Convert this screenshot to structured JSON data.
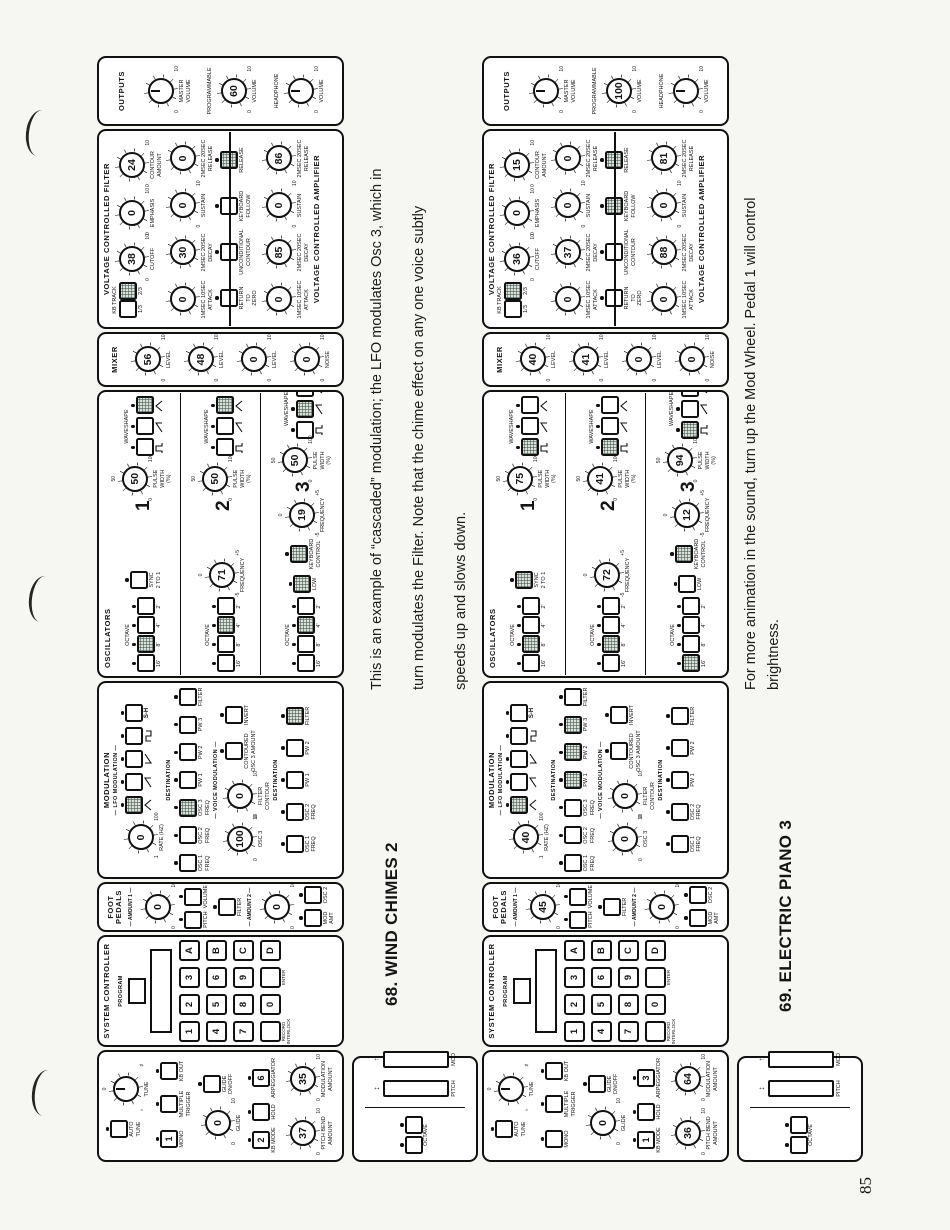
{
  "page": {
    "number": "85",
    "paper_color": "#f6f6f2",
    "ink_color": "#151515"
  },
  "labels": {
    "performance": {
      "auto_tune": "AUTO TUNE",
      "tune": "TUNE",
      "mono": "MONO",
      "multiple_trigger": "MULTIPLE TRIGGER",
      "kb_out": "KB OUT",
      "glide": "GLIDE",
      "glide_on_off": "GLIDE ON/OFF",
      "kb_mode": "KB MODE",
      "hold": "HOLD",
      "arpeggiator": "ARPEGGIATOR",
      "pitch_bend_amount": "PITCH BEND AMOUNT",
      "modulation_amount": "MODULATION AMOUNT"
    },
    "wheels": {
      "octave": "OCTAVE",
      "pitch": "PITCH",
      "mod": "MOD"
    },
    "system_controller": {
      "title": "SYSTEM CONTROLLER",
      "program": "PROGRAM",
      "keys": [
        [
          "1",
          "2",
          "3",
          "A"
        ],
        [
          "4",
          "5",
          "6",
          "B"
        ],
        [
          "7",
          "8",
          "9",
          "C"
        ],
        [
          "",
          "0",
          "",
          "D"
        ]
      ],
      "record_interlock": "RECORD INTERLOCK",
      "enter": "ENTER"
    },
    "foot_pedals": {
      "title": "FOOT PEDALS",
      "amount_1": "AMOUNT 1",
      "amount_2": "AMOUNT 2",
      "pitch": "PITCH",
      "volume": "VOLUME",
      "filter": "FILTER",
      "mod_amt": "MOD AMT",
      "osc_2": "OSC 2"
    },
    "modulation": {
      "title": "MODULATION",
      "lfo": "LFO MODULATION",
      "rate": "RATE (HZ)",
      "rate_scale": [
        ".1",
        "100"
      ],
      "destination": "DESTINATION",
      "waveforms": [
        "triangle",
        "saw-up",
        "saw-down",
        "square",
        "sample-hold"
      ],
      "sample_hold_text": "S-H",
      "lfo_destinations": [
        "OSC 1 FREQ",
        "OSC 2 FREQ",
        "OSC 3 FREQ",
        "PW 1",
        "PW 2",
        "PW 3",
        "FILTER"
      ],
      "voice": "VOICE MODULATION",
      "osc_3": "OSC 3",
      "filter_contour": "FILTER CONTOUR",
      "contoured": "CONTOURED OSC 3 AMOUNT",
      "invert": "INVERT",
      "voice_destinations": [
        "OSC 1 FREQ",
        "OSC 2 FREQ",
        "PW 1",
        "PW 2",
        "FILTER"
      ]
    },
    "oscillators": {
      "title": "OSCILLATORS",
      "octave": "OCTAVE",
      "octaves": [
        "16'",
        "8'",
        "4'",
        "2'"
      ],
      "sync": "SYNC 2 TO 1",
      "frequency": "FREQUENCY",
      "freq_scale": [
        "-5",
        "+5",
        "0"
      ],
      "low": "LOW",
      "keyboard_control": "KEYBOARD CONTROL",
      "pulse_width": "PULSE WIDTH (%)",
      "pw_scale": [
        "0",
        "100",
        "50"
      ],
      "waveshape": "WAVESHAPE",
      "waveshapes": [
        "pulse",
        "saw",
        "triangle"
      ],
      "numbers": [
        "1",
        "2",
        "3"
      ]
    },
    "mixer": {
      "title": "MIXER",
      "level": "LEVEL",
      "noise": "NOISE"
    },
    "vcf": {
      "title": "VOLTAGE CONTROLLED FILTER",
      "kb_track": "KB TRACK",
      "kb_track_options": [
        "1/3",
        "2/3"
      ],
      "cutoff": "CUTOFF",
      "emphasis": "EMPHASIS",
      "contour_amount": "CONTOUR AMOUNT",
      "attack": "ATTACK",
      "decay": "DECAY",
      "sustain": "SUSTAIN",
      "release": "RELEASE",
      "attack_scale": "1MSEC 10SEC",
      "decay_scale": "2MSEC 20SEC",
      "release_scale": "2MSEC 20SEC",
      "mode_buttons": [
        "RETURN TO ZERO",
        "UNCONDITIONAL CONTOUR",
        "KEYBOARD FOLLOW",
        "RELEASE"
      ]
    },
    "vca": {
      "title": "VOLTAGE CONTROLLED AMPLIFIER"
    },
    "outputs": {
      "title": "OUTPUTS",
      "master_volume": "MASTER VOLUME",
      "programmable": "PROGRAMMABLE",
      "volume": "VOLUME",
      "headphone": "HEADPHONE"
    },
    "tune_scale": [
      "♭",
      "♯",
      "0"
    ],
    "generic_scale": [
      "0",
      "10"
    ]
  },
  "patches": [
    {
      "title": "68. WIND CHIMES 2",
      "description": [
        "This is an example of “cascaded” modulation; the LFO modulates Osc 3, which in",
        "turn modulates the Filter. Note that the chime effect on any one voice subtly",
        "speeds up and slows down."
      ],
      "performance": {
        "mono": "1",
        "multiple_trigger": false,
        "kb_out": false,
        "glide": "0",
        "glide_on": false,
        "kb_mode": "2",
        "hold": false,
        "arpeggiator": "6",
        "pitch_bend_amount": "37",
        "modulation_amount": "35"
      },
      "foot_pedals": {
        "amount_1": "0",
        "amount_2": "0",
        "pitch": false,
        "volume": false,
        "filter": false,
        "mod_amt": false,
        "osc_2": false
      },
      "modulation": {
        "rate": "0",
        "waveform": 0,
        "lfo_destinations": [
          2
        ],
        "osc_3": "100",
        "filter_contour": "0",
        "contoured": false,
        "invert": false,
        "voice_destinations": [
          4
        ]
      },
      "oscillators": [
        {
          "octave": 1,
          "sync": false,
          "pulse_width": "50",
          "waveshape": 2
        },
        {
          "octave": 2,
          "frequency": "71",
          "pulse_width": "50",
          "waveshape": 2
        },
        {
          "octave": 2,
          "frequency": "19",
          "low": true,
          "keyboard_control": true,
          "pulse_width": "50",
          "waveshape": 1
        }
      ],
      "mixer": [
        "56",
        "48",
        "0",
        "0"
      ],
      "vcf": {
        "kb_track": 1,
        "cutoff": "38",
        "emphasis": "0",
        "contour_amount": "24",
        "attack": "0",
        "decay": "30",
        "sustain": "0",
        "release": "0",
        "modes": [
          false,
          false,
          false,
          true
        ]
      },
      "vca": {
        "attack": "0",
        "decay": "85",
        "sustain": "0",
        "release": "86"
      },
      "outputs": {
        "programmable_volume": "60"
      }
    },
    {
      "title": "69. ELECTRIC PIANO 3",
      "description": [
        "For more animation in the sound, turn up the Mod Wheel. Pedal 1 will control",
        "brightness."
      ],
      "performance": {
        "mono": "",
        "multiple_trigger": false,
        "kb_out": false,
        "glide": "0",
        "glide_on": false,
        "kb_mode": "1",
        "hold": false,
        "arpeggiator": "3",
        "pitch_bend_amount": "36",
        "modulation_amount": "64"
      },
      "foot_pedals": {
        "amount_1": "45",
        "amount_2": "0",
        "pitch": false,
        "volume": false,
        "filter": false,
        "mod_amt": false,
        "osc_2": false
      },
      "modulation": {
        "rate": "40",
        "waveform": 0,
        "lfo_destinations": [
          3,
          4,
          5
        ],
        "osc_3": "0",
        "filter_contour": "0",
        "contoured": false,
        "invert": false,
        "voice_destinations": []
      },
      "oscillators": [
        {
          "octave": 1,
          "sync": true,
          "pulse_width": "75",
          "waveshape": 0
        },
        {
          "octave": 1,
          "frequency": "72",
          "pulse_width": "41",
          "waveshape": 0
        },
        {
          "octave": 0,
          "frequency": "12",
          "low": false,
          "keyboard_control": true,
          "pulse_width": "94",
          "waveshape": 0
        }
      ],
      "mixer": [
        "40",
        "41",
        "0",
        "0"
      ],
      "vcf": {
        "kb_track": 1,
        "cutoff": "36",
        "emphasis": "0",
        "contour_amount": "15",
        "attack": "0",
        "decay": "37",
        "sustain": "0",
        "release": "0",
        "modes": [
          false,
          false,
          true,
          true
        ]
      },
      "vca": {
        "attack": "0",
        "decay": "88",
        "sustain": "0",
        "release": "81"
      },
      "outputs": {
        "programmable_volume": "100"
      }
    }
  ]
}
